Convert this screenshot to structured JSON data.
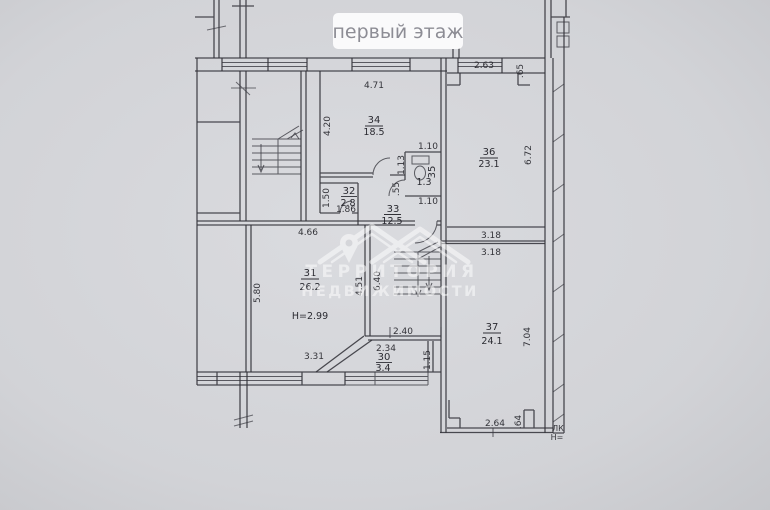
{
  "badge": {
    "label": "первый этаж"
  },
  "watermark": {
    "line1": "ТЕРРИТОРИЯ",
    "line2": "НЕДВИЖИМОСТИ"
  },
  "rooms": {
    "r30": {
      "number": "30",
      "area": "3.4"
    },
    "r31": {
      "number": "31",
      "area": "26.2",
      "height": "Н=2.99"
    },
    "r32": {
      "number": "32",
      "area": "2.8"
    },
    "r33": {
      "number": "33",
      "area": "12.5"
    },
    "r34": {
      "number": "34",
      "area": "18.5"
    },
    "r35": {
      "number": "35",
      "area": "1.3"
    },
    "r36": {
      "number": "36",
      "area": "23.1"
    },
    "r37": {
      "number": "37",
      "area": "24.1"
    }
  },
  "dims": {
    "d34_top": "4.71",
    "d34_left": "4.20",
    "d36_top": "2.63",
    "d36_notch": ".65",
    "d36_right": "6.72",
    "wc_top": "1.10",
    "wc_left": "1.13",
    "wc_left2": ".55",
    "wc_bottom": "1.10",
    "d32_left": "1.50",
    "d32_bottom": "1.86",
    "d31_top": "4.66",
    "d31_left": "5.80",
    "d31_right": "4.51",
    "d31_bottom": "3.31",
    "stair_hall": "6.40",
    "corr_upper": "3.18",
    "corr_lower": "3.18",
    "d37_right": "7.04",
    "d30_top": "2.40",
    "d30_width": "2.34",
    "d30_right": "1.15",
    "bottom_width": "2.64",
    "bottom_notch": ".64"
  },
  "edge_labels": {
    "stairwell": "ЛК",
    "stairwell_height": "Н="
  }
}
